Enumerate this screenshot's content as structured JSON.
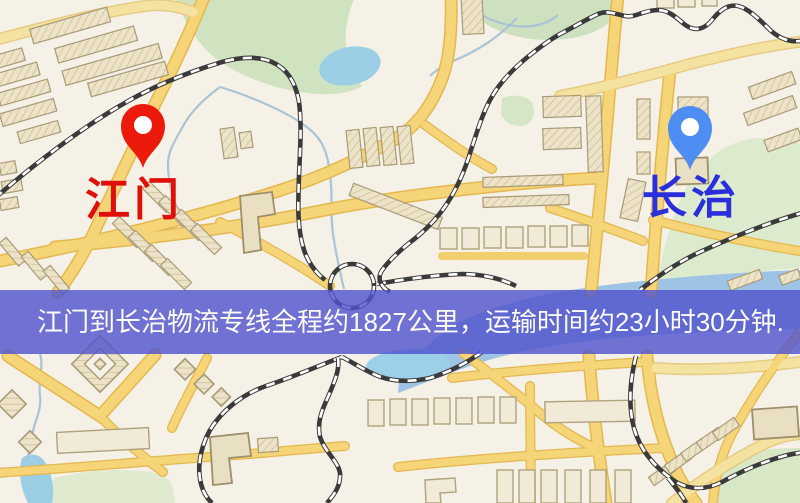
{
  "banner": {
    "text": "江门到长治物流专线全程约1827公里，运输时间约23小时30分钟.",
    "background_color": "#5254ce",
    "text_color": "#fdfcf4"
  },
  "markers": {
    "origin": {
      "label": "江门",
      "icon": "red-map-pin-icon",
      "pin_color": "#ec1a0b",
      "label_color": "#e01008"
    },
    "destination": {
      "label": "长治",
      "icon": "blue-map-pin-icon",
      "pin_color": "#4e8ef2",
      "label_color": "#2b2fd9"
    }
  },
  "map_style": {
    "background_color": "#f5f1e7",
    "road_color": "#f6d478",
    "road_casing_color": "#e3b84f",
    "park_color": "#cfe3c0",
    "water_color": "#9ccfe6",
    "railway_color": "#3a3a3a",
    "building_color": "#ece3c9"
  }
}
